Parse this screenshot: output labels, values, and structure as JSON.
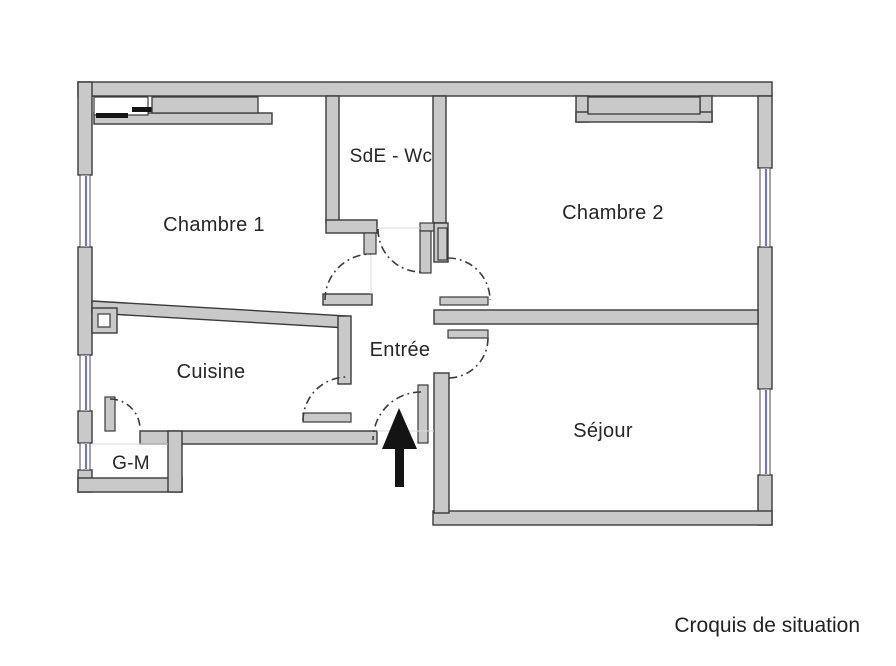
{
  "caption": "Croquis de situation",
  "rooms": {
    "chambre1": "Chambre 1",
    "sde_wc": "SdE - Wc",
    "chambre2": "Chambre 2",
    "entree": "Entrée",
    "cuisine": "Cuisine",
    "sejour": "Séjour",
    "garde_manger": "G-M"
  },
  "icons": {
    "entrance_arrow": "up-arrow"
  },
  "colors": {
    "wall_fill": "#c9c9c9",
    "wall_stroke": "#3a3a3a",
    "window_glass": "#7575c8",
    "label_text": "#262626",
    "arrow": "#141414",
    "background": "#ffffff"
  }
}
